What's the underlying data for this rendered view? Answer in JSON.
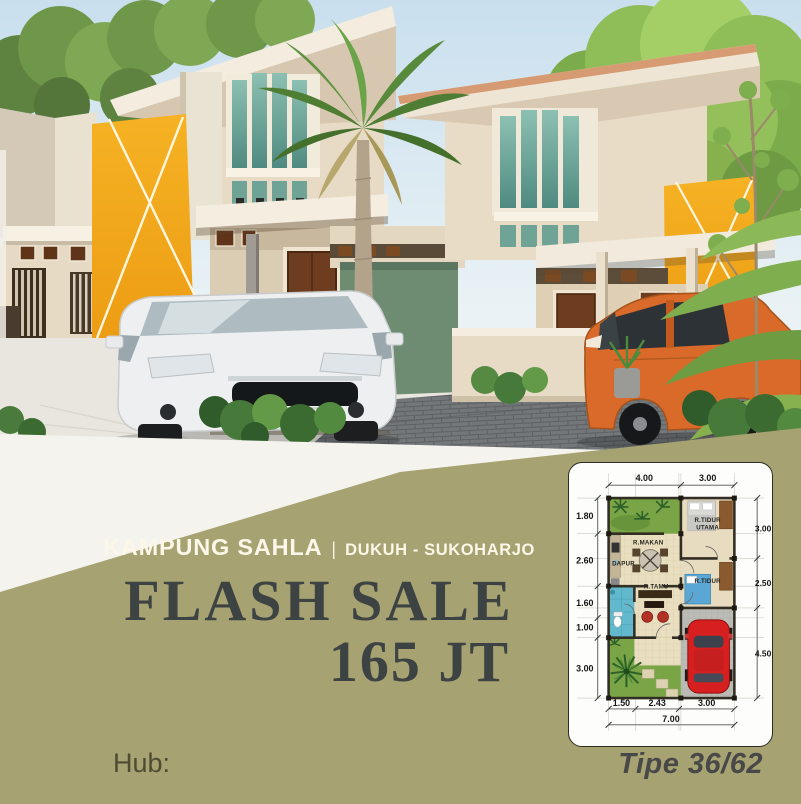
{
  "flyer": {
    "project": {
      "name": "KAMPUNG SAHLA",
      "separator": "|",
      "location": "DUKUH - SUKOHARJO"
    },
    "promo": {
      "headline": "FLASH SALE",
      "price": "165 JT"
    },
    "contact": {
      "label": "Hub:"
    },
    "floorplan": {
      "type_label": "Tipe 36/62",
      "rooms": {
        "master_bedroom_line1": "R.TIDUR",
        "master_bedroom_line2": "UTAMA",
        "dining": "R.MAKAN",
        "kitchen": "DAPUR",
        "bedroom": "R.TIDUR",
        "living": "R.TAMU"
      },
      "dimensions": {
        "top": [
          "4.00",
          "3.00"
        ],
        "left": [
          "1.80",
          "2.60",
          "1.60",
          "1.00",
          "3.00"
        ],
        "right": [
          "3.00",
          "2.50",
          "4.50"
        ],
        "bottom": [
          "1.50",
          "2.43",
          "3.00"
        ],
        "total_width": "7.00"
      }
    },
    "colors": {
      "background_olive": "#a6a271",
      "headline_text": "#3d4243",
      "title_text": "#fcf7e9",
      "accent_orange": "#f2a31c",
      "type_text": "#484848"
    }
  }
}
